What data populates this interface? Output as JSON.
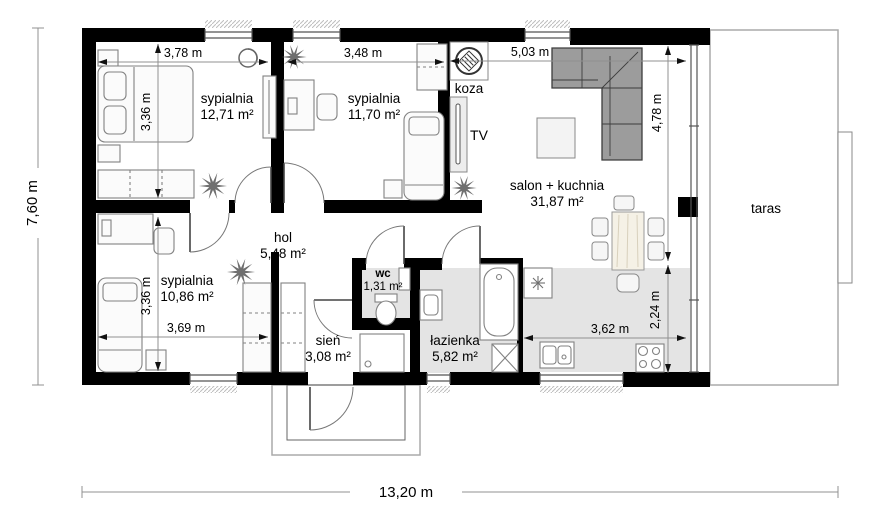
{
  "plan": {
    "rooms": {
      "bedroom1": {
        "name": "sypialnia",
        "area": "12,71 m²"
      },
      "bedroom2": {
        "name": "sypialnia",
        "area": "11,70 m²"
      },
      "bedroom3": {
        "name": "sypialnia",
        "area": "10,86 m²"
      },
      "hall": {
        "name": "hol",
        "area": "5,48 m²"
      },
      "wc": {
        "name": "wc",
        "area": "1,31 m²"
      },
      "vestibule": {
        "name": "sień",
        "area": "3,08 m²"
      },
      "bathroom": {
        "name": "łazienka",
        "area": "5,82 m²"
      },
      "living": {
        "name": "salon + kuchnia",
        "area": "31,87 m²"
      },
      "terrace": {
        "name": "taras"
      }
    },
    "labels": {
      "stove": "koza",
      "tv": "TV"
    },
    "dimensions": {
      "overall_width": "13,20 m",
      "overall_height": "7,60 m",
      "bedroom1_width": "3,78 m",
      "bedroom1_height": "3,36 m",
      "bedroom2_width": "3,48 m",
      "living_width": "5,03 m",
      "living_height": "4,78 m",
      "kitchen_width": "3,62 m",
      "kitchen_height": "2,24 m",
      "bedroom3_width": "3,69 m",
      "bedroom3_height": "3,36 m"
    },
    "colors": {
      "wall": "#000000",
      "wet_floor": "#e4e4e4",
      "sofa": "#9c9c9c",
      "dim_line": "#909090"
    }
  }
}
